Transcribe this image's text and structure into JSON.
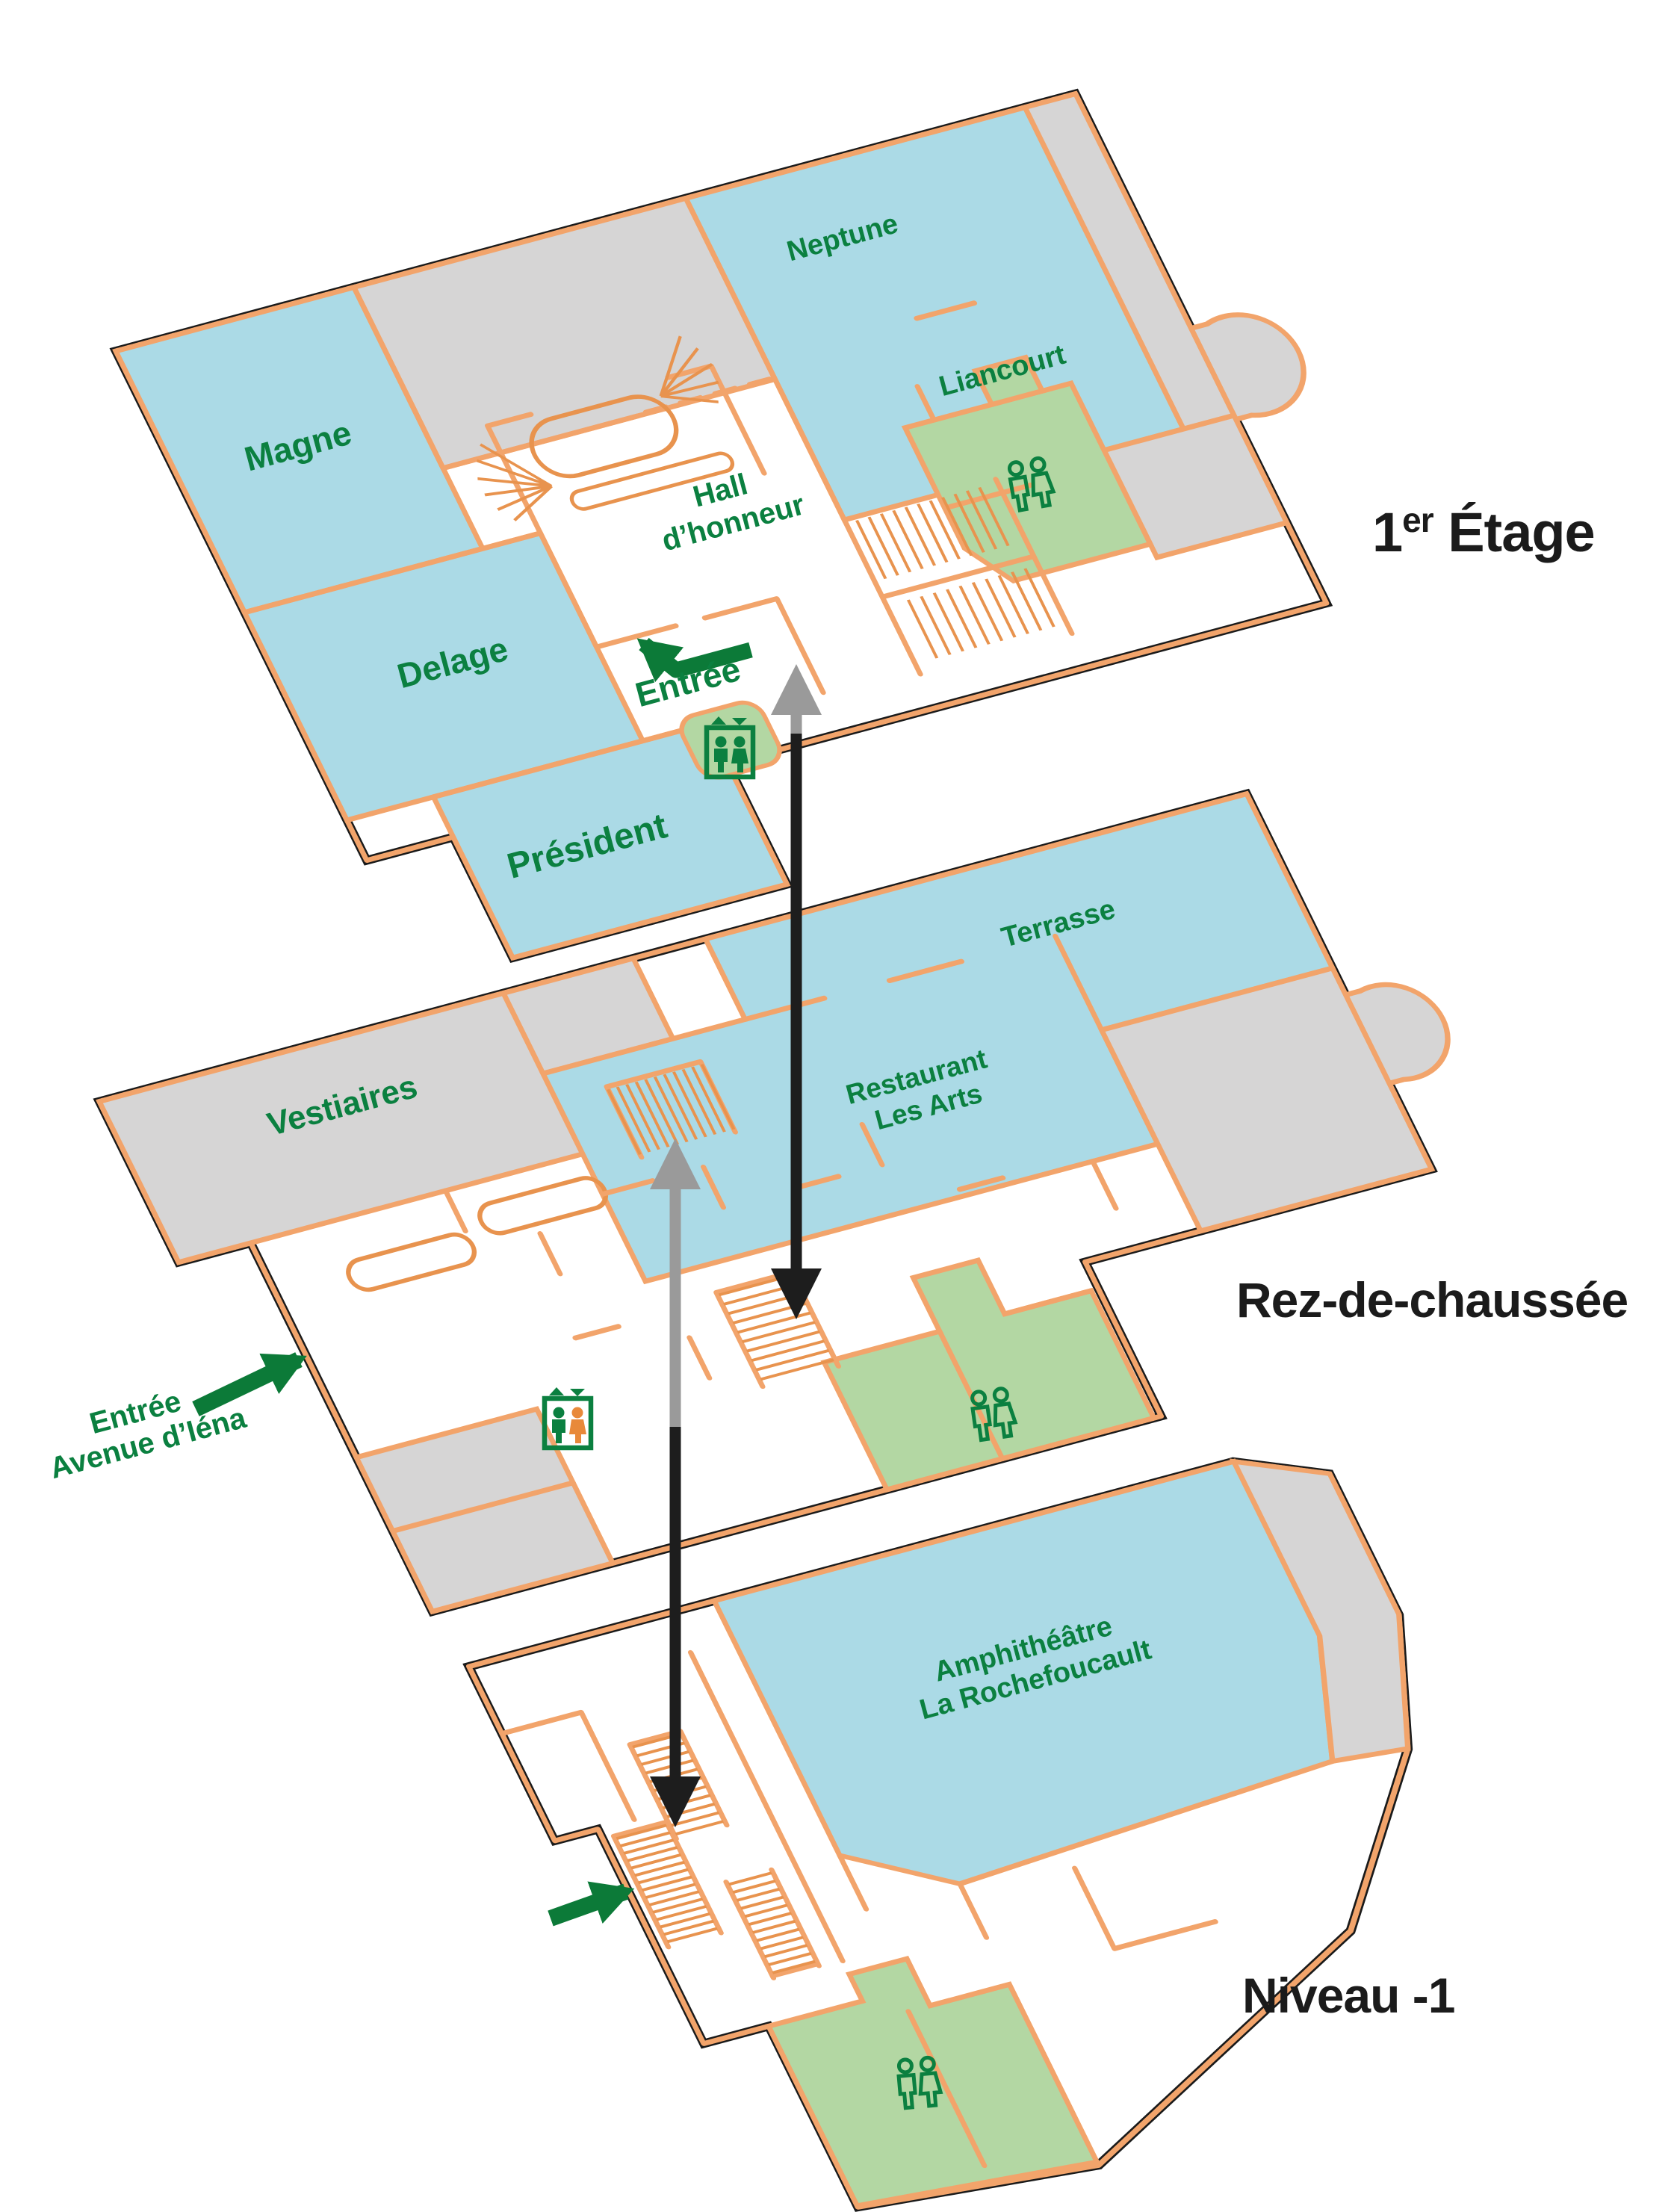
{
  "diagram_type": "building-level-plans",
  "levels": [
    {
      "name": "1er Étage",
      "rooms": [
        "Magne",
        "Neptune",
        "Liancourt",
        "Delage",
        "Président",
        "Hall d’honneur"
      ],
      "entrance": "Entrée",
      "facilities": [
        "restroom",
        "elevator",
        "stairs"
      ]
    },
    {
      "name": "Rez-de-chaussée",
      "rooms": [
        "Vestiaires",
        "Terrasse",
        "Restaurant Les Arts"
      ],
      "entrance": "Entrée Avenue d’Iéna",
      "facilities": [
        "restroom",
        "elevator",
        "stairs"
      ]
    },
    {
      "name": "Niveau -1",
      "rooms": [
        "Amphithéâtre La Rochefoucault"
      ],
      "facilities": [
        "restroom",
        "stairs"
      ]
    }
  ],
  "labels": {
    "f1": {
      "num": "1",
      "sup": "er",
      "rest": " Étage",
      "magne": "Magne",
      "neptune": "Neptune",
      "liancourt": "Liancourt",
      "delage": "Delage",
      "president": "Président",
      "hall1": "Hall",
      "hall2": "d’honneur",
      "entree": "Entrée"
    },
    "rdc": {
      "name": "Rez-de-chaussée",
      "vestiaires": "Vestiaires",
      "terrasse": "Terrasse",
      "restaurant1": "Restaurant",
      "restaurant2": "Les Arts",
      "entree1": "Entrée",
      "entree2": "Avenue d’Iéna"
    },
    "n1": {
      "name": "Niveau -1",
      "amphi1": "Amphithéâtre",
      "amphi2": "La Rochefoucault"
    }
  },
  "icons": {
    "restroom": "wc-figures-icon",
    "elevator": "elevator-icon",
    "elevator_direction": "up-down-triangles",
    "stairs": "hatched-stairs",
    "up_link": "gray-up-arrow",
    "down_link": "black-down-arrow",
    "entrance": "green-entrance-arrow"
  },
  "colors": {
    "room_blue": "#abdae6",
    "room_gray": "#d6d5d5",
    "room_green": "#b3d7a3",
    "wall_orange": "#f2a46b",
    "wall_outline": "#1a1a1a",
    "text_green": "#0b8040",
    "level_text": "#1b1b1b",
    "arrow_gray": "#9a9a9a",
    "arrow_black": "#1d1d1d",
    "arrow_green": "#0c7a38",
    "elevator_highlight": "#e8893a"
  }
}
